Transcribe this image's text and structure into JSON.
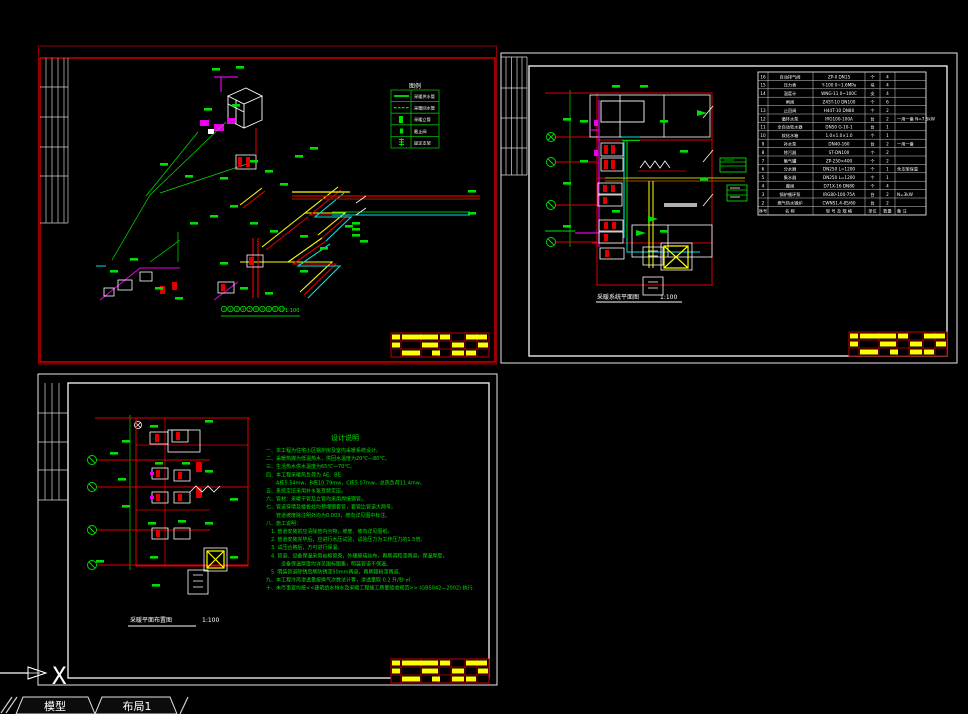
{
  "window": {
    "tabs": [
      {
        "label": "模型"
      },
      {
        "label": "布局1"
      }
    ],
    "ucs": {
      "x_label": "X"
    }
  },
  "sheetA": {
    "scale": "1:100",
    "legend": {
      "title": "图例",
      "rows": [
        {
          "label": "采暖供水管"
        },
        {
          "label": "采暖回水管"
        },
        {
          "label": "采暖立管"
        },
        {
          "label": "截止阀"
        },
        {
          "label": "固定支架"
        }
      ]
    },
    "axis_bubbles": [
      {
        "n": "1"
      },
      {
        "n": "2"
      },
      {
        "n": "3"
      },
      {
        "n": "4"
      },
      {
        "n": "5"
      },
      {
        "n": "6"
      },
      {
        "n": "7"
      },
      {
        "n": "8"
      },
      {
        "n": "9"
      },
      {
        "n": "10"
      }
    ]
  },
  "sheetB": {
    "title": "采暖系统平面图",
    "scale": "1:100",
    "table": {
      "header": {
        "no": "序号",
        "name": "名 称",
        "spec": "型 号 及 规 格",
        "unit": "单位",
        "qty": "数量",
        "rem": "备 注"
      },
      "rows": [
        {
          "no": "16",
          "name": "自动排气阀",
          "spec": "ZP-II DN15",
          "unit": "个",
          "qty": "4",
          "rem": ""
        },
        {
          "no": "15",
          "name": "压力表",
          "spec": "Y-100 0~1.6MPa",
          "unit": "块",
          "qty": "4",
          "rem": ""
        },
        {
          "no": "14",
          "name": "温度计",
          "spec": "WNG-11 0~100C",
          "unit": "支",
          "qty": "4",
          "rem": ""
        },
        {
          "no": "",
          "name": "闸阀",
          "spec": "Z45T-10 DN100",
          "unit": "个",
          "qty": "6",
          "rem": ""
        },
        {
          "no": "13",
          "name": "止回阀",
          "spec": "H44T-10 DN80",
          "unit": "个",
          "qty": "2",
          "rem": ""
        },
        {
          "no": "12",
          "name": "循环水泵",
          "spec": "IRG100-100A",
          "unit": "台",
          "qty": "2",
          "rem": "一用一备 N=7.5kW"
        },
        {
          "no": "11",
          "name": "全自动软水器",
          "spec": "DN50 G-10-1",
          "unit": "台",
          "qty": "1",
          "rem": ""
        },
        {
          "no": "10",
          "name": "软化水箱",
          "spec": "1.0×1.0×1.0",
          "unit": "个",
          "qty": "1",
          "rem": ""
        },
        {
          "no": "9",
          "name": "补水泵",
          "spec": "DN40-160",
          "unit": "台",
          "qty": "2",
          "rem": "一用一备"
        },
        {
          "no": "8",
          "name": "除污器",
          "spec": "ST-DN100",
          "unit": "个",
          "qty": "2",
          "rem": ""
        },
        {
          "no": "7",
          "name": "集气罐",
          "spec": "ZP-250×400",
          "unit": "个",
          "qty": "2",
          "rem": ""
        },
        {
          "no": "6",
          "name": "分水器",
          "spec": "DN250 L=1200",
          "unit": "个",
          "qty": "1",
          "rem": "含支架保温"
        },
        {
          "no": "5",
          "name": "集水器",
          "spec": "DN250 L=1200",
          "unit": "个",
          "qty": "1",
          "rem": ""
        },
        {
          "no": "4",
          "name": "蝶阀",
          "spec": "D71X-16 DN80",
          "unit": "个",
          "qty": "4",
          "rem": ""
        },
        {
          "no": "3",
          "name": "锅炉循环泵",
          "spec": "IRG80-100-75A",
          "unit": "台",
          "qty": "2",
          "rem": "N=3kW"
        },
        {
          "no": "2",
          "name": "燃气热水锅炉",
          "spec": "CWNS1.4-85/60",
          "unit": "台",
          "qty": "2",
          "rem": ""
        }
      ]
    }
  },
  "sheetC": {
    "title": "采暖平面布置图",
    "scale": "1:100",
    "notes": {
      "title": "设计说明",
      "lines": [
        {
          "t": "一、本工程为住宅小区锅炉房及室内采暖系统设计。"
        },
        {
          "t": "二、采暖热媒为低温热水，供回水温度为20℃—80℃。"
        },
        {
          "t": "三、生活热水供水温度为65℃—70℃。"
        },
        {
          "t": "四、本工程采暖热负荷为 AE、BE："
        },
        {
          "t": "　　A栋5.54mw，B栋10.79mw，C栋5.07mw，总热负荷11.4mw。"
        },
        {
          "t": "五、系统定压采用补水泵变频定压。"
        },
        {
          "t": "六、管材：采暖干管及立管均采用焊接钢管。"
        },
        {
          "t": "七、管道穿墙及楼板处均预埋钢套管，套管比管道大两号。"
        },
        {
          "t": "　　管道坡度除注明外均为0.003，坡向详见图中标注。"
        },
        {
          "t": "八、施工说明："
        },
        {
          "t": "　1. 管道安装前应清除管内污物，坡度、坡向详见图纸。"
        },
        {
          "t": "　2. 管道安装完毕后，应进行水压试验，试验压力为工作压力的1.5倍。"
        },
        {
          "t": "　3. 试压合格后，方可进行保温。"
        },
        {
          "t": "　4. 管道、设备保温采用岩棉管壳，外缠玻璃丝布，再刷调和漆两道，保温厚度，"
        },
        {
          "t": "　　　设备保温厚度均详见国标图集，明装管道不保温。"
        },
        {
          "t": "　5. 明装管道除锈后刷防锈漆50mm两道，再刷银粉漆两道。"
        },
        {
          "t": "九、本工程冷风渗透量按换气次数法计算，渗透量取  0.2  升/秒·㎡."
        },
        {
          "t": "十、未尽事宜均按<<建筑给水排水及采暖工程施工质量验收规范>> (GB5042—2002)  执行."
        }
      ]
    }
  }
}
